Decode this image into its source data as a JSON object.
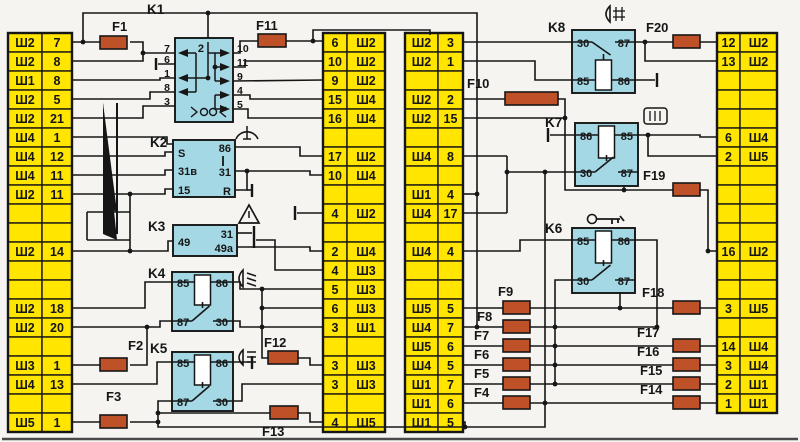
{
  "diagram": {
    "kind": "vehicle fuse and relay mounting block wiring diagram",
    "connector_prefix_values": [
      "Ш1",
      "Ш2",
      "Ш3",
      "Ш4",
      "Ш5"
    ]
  },
  "colors": {
    "background": "#f5f4f0",
    "connector_block_fill": "#ffe500",
    "relay_fill": "#a3d8e4",
    "fuse_fill": "#bf5128",
    "line": "#161616"
  },
  "columns": {
    "left": {
      "rows": [
        {
          "sh": "Ш2",
          "num": "7"
        },
        {
          "sh": "Ш2",
          "num": "8"
        },
        {
          "sh": "Ш1",
          "num": "8"
        },
        {
          "sh": "Ш2",
          "num": "5"
        },
        {
          "sh": "Ш2",
          "num": "21"
        },
        {
          "sh": "Ш4",
          "num": "1"
        },
        {
          "sh": "Ш4",
          "num": "12"
        },
        {
          "sh": "Ш4",
          "num": "11"
        },
        {
          "sh": "Ш2",
          "num": "11"
        },
        null,
        null,
        {
          "sh": "Ш2",
          "num": "14"
        },
        null,
        null,
        {
          "sh": "Ш2",
          "num": "18"
        },
        {
          "sh": "Ш2",
          "num": "20"
        },
        null,
        {
          "sh": "Ш3",
          "num": "1"
        },
        {
          "sh": "Ш4",
          "num": "13"
        },
        null,
        {
          "sh": "Ш5",
          "num": "1"
        }
      ]
    },
    "middle_left": {
      "rows": [
        {
          "num": "6",
          "sh": "Ш2"
        },
        {
          "num": "10",
          "sh": "Ш2"
        },
        {
          "num": "9",
          "sh": "Ш2"
        },
        {
          "num": "15",
          "sh": "Ш4"
        },
        {
          "num": "16",
          "sh": "Ш4"
        },
        null,
        {
          "num": "17",
          "sh": "Ш2"
        },
        {
          "num": "10",
          "sh": "Ш4"
        },
        null,
        {
          "num": "4",
          "sh": "Ш2"
        },
        null,
        {
          "num": "2",
          "sh": "Ш4"
        },
        {
          "num": "4",
          "sh": "Ш3"
        },
        {
          "num": "5",
          "sh": "Ш3"
        },
        {
          "num": "6",
          "sh": "Ш3"
        },
        {
          "num": "3",
          "sh": "Ш1"
        },
        null,
        {
          "num": "3",
          "sh": "Ш3"
        },
        {
          "num": "3",
          "sh": "Ш3"
        },
        null,
        {
          "num": "4",
          "sh": "Ш5"
        }
      ]
    },
    "middle_right": {
      "rows": [
        {
          "sh": "Ш2",
          "num": "3"
        },
        {
          "sh": "Ш2",
          "num": "1"
        },
        null,
        {
          "sh": "Ш2",
          "num": "2"
        },
        {
          "sh": "Ш2",
          "num": "15"
        },
        null,
        {
          "sh": "Ш4",
          "num": "8"
        },
        null,
        {
          "sh": "Ш1",
          "num": "4"
        },
        {
          "sh": "Ш4",
          "num": "17"
        },
        null,
        {
          "sh": "Ш4",
          "num": "4"
        },
        null,
        null,
        {
          "sh": "Ш5",
          "num": "5"
        },
        {
          "sh": "Ш4",
          "num": "7"
        },
        {
          "sh": "Ш5",
          "num": "6"
        },
        {
          "sh": "Ш4",
          "num": "5"
        },
        {
          "sh": "Ш1",
          "num": "7"
        },
        {
          "sh": "Ш1",
          "num": "6"
        },
        {
          "sh": "Ш1",
          "num": "5"
        }
      ]
    },
    "right": {
      "rows": [
        {
          "num": "12",
          "sh": "Ш2"
        },
        {
          "num": "13",
          "sh": "Ш2"
        },
        null,
        null,
        null,
        {
          "num": "6",
          "sh": "Ш4"
        },
        {
          "num": "2",
          "sh": "Ш5"
        },
        null,
        null,
        null,
        null,
        {
          "num": "16",
          "sh": "Ш2"
        },
        null,
        null,
        {
          "num": "3",
          "sh": "Ш5"
        },
        null,
        {
          "num": "14",
          "sh": "Ш4"
        },
        {
          "num": "3",
          "sh": "Ш4"
        },
        {
          "num": "2",
          "sh": "Ш1"
        },
        {
          "num": "1",
          "sh": "Ш1"
        }
      ]
    }
  },
  "relays": {
    "K1": {
      "label": "K1",
      "top_pin": "2",
      "pins_left": [
        "7",
        "6",
        "1",
        "8",
        "3"
      ],
      "pins_right": [
        "10",
        "11",
        "9",
        "4",
        "5"
      ],
      "icon": "lamp-check-icon"
    },
    "K2": {
      "label": "K2",
      "pins_left": [
        "S",
        "31в",
        "15"
      ],
      "pins_right": [
        "86",
        "31",
        "R"
      ],
      "icon": "wiper-icon"
    },
    "K3": {
      "label": "K3",
      "pins_left": [
        "49"
      ],
      "pins_right": [
        "31",
        "49а"
      ],
      "icon": "hazard-warning-icon"
    },
    "K4": {
      "label": "K4",
      "pins": {
        "tl": "85",
        "tr": "86",
        "bl": "87",
        "br": "30"
      },
      "icon": "low-beam-icon"
    },
    "K5": {
      "label": "K5",
      "pins": {
        "tl": "85",
        "tr": "86",
        "bl": "87",
        "br": "30"
      },
      "icon": "high-beam-icon"
    },
    "K6": {
      "label": "K6",
      "pins": {
        "tl": "85",
        "tr": "86",
        "bl": "30",
        "br": "87"
      },
      "icon": "ignition-key-icon"
    },
    "K7": {
      "label": "K7",
      "pins": {
        "tl": "86",
        "tr": "85",
        "bl": "30",
        "br": "87"
      },
      "icon": "heated-rear-window-icon"
    },
    "K8": {
      "label": "K8",
      "pins": {
        "tl": "30",
        "tr": "87",
        "bl": "85",
        "br": "86"
      },
      "icon": "rear-fog-light-icon"
    }
  },
  "fuses": {
    "F1": {
      "label": "F1"
    },
    "F2": {
      "label": "F2"
    },
    "F3": {
      "label": "F3"
    },
    "F4": {
      "label": "F4"
    },
    "F5": {
      "label": "F5"
    },
    "F6": {
      "label": "F6"
    },
    "F7": {
      "label": "F7"
    },
    "F8": {
      "label": "F8"
    },
    "F9": {
      "label": "F9"
    },
    "F10": {
      "label": "F10"
    },
    "F11": {
      "label": "F11"
    },
    "F12": {
      "label": "F12"
    },
    "F13": {
      "label": "F13"
    },
    "F14": {
      "label": "F14"
    },
    "F15": {
      "label": "F15"
    },
    "F16": {
      "label": "F16"
    },
    "F17": {
      "label": "F17"
    },
    "F18": {
      "label": "F18"
    },
    "F19": {
      "label": "F19"
    },
    "F20": {
      "label": "F20"
    }
  }
}
